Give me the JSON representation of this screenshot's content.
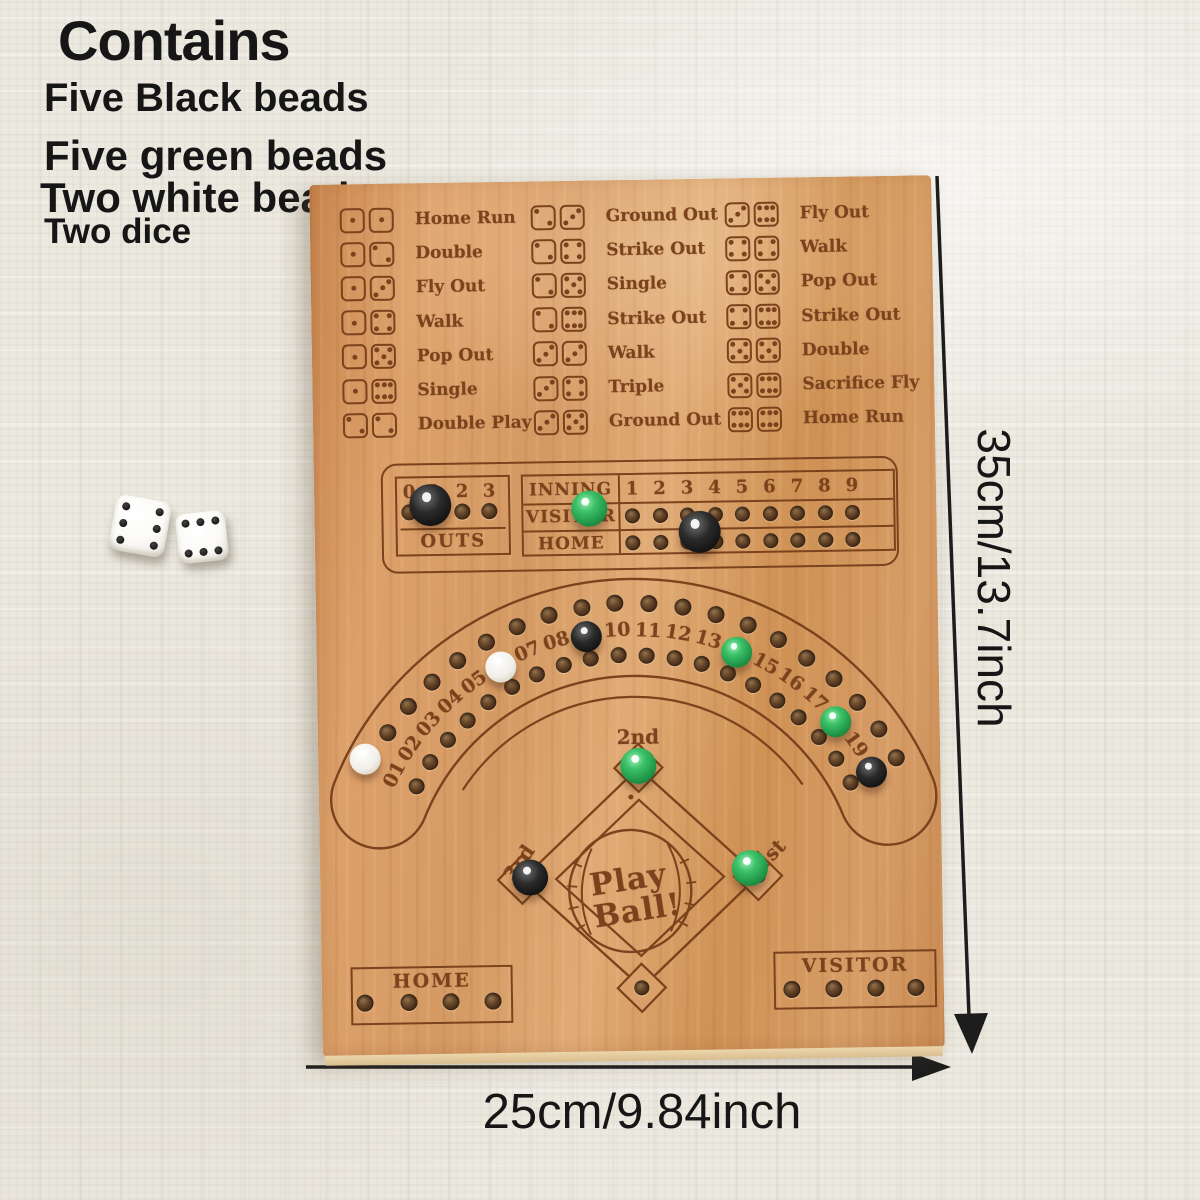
{
  "annotations": {
    "contains_title": "Contains",
    "contains_items": [
      "Five Black beads",
      "Five green beads",
      "Two white beads",
      "Two dice"
    ],
    "height_label": "35cm/13.7inch",
    "width_label": "25cm/9.84inch"
  },
  "photo_dice": [
    {
      "value": 6
    },
    {
      "value": 6
    }
  ],
  "board": {
    "dice_legend": {
      "columns": [
        {
          "rows": [
            {
              "dice": [
                1,
                1
              ],
              "label": "Home Run"
            },
            {
              "dice": [
                1,
                2
              ],
              "label": "Double"
            },
            {
              "dice": [
                1,
                3
              ],
              "label": "Fly Out"
            },
            {
              "dice": [
                1,
                4
              ],
              "label": "Walk"
            },
            {
              "dice": [
                1,
                5
              ],
              "label": "Pop Out"
            },
            {
              "dice": [
                1,
                6
              ],
              "label": "Single"
            },
            {
              "dice": [
                2,
                2
              ],
              "label": "Double Play"
            }
          ]
        },
        {
          "rows": [
            {
              "dice": [
                2,
                3
              ],
              "label": "Ground Out"
            },
            {
              "dice": [
                2,
                4
              ],
              "label": "Strike Out"
            },
            {
              "dice": [
                2,
                5
              ],
              "label": "Single"
            },
            {
              "dice": [
                2,
                6
              ],
              "label": "Strike Out"
            },
            {
              "dice": [
                3,
                3
              ],
              "label": "Walk"
            },
            {
              "dice": [
                3,
                4
              ],
              "label": "Triple"
            },
            {
              "dice": [
                3,
                5
              ],
              "label": "Ground Out"
            }
          ]
        },
        {
          "rows": [
            {
              "dice": [
                3,
                6
              ],
              "label": "Fly Out"
            },
            {
              "dice": [
                4,
                4
              ],
              "label": "Walk"
            },
            {
              "dice": [
                4,
                5
              ],
              "label": "Pop Out"
            },
            {
              "dice": [
                4,
                6
              ],
              "label": "Strike Out"
            },
            {
              "dice": [
                5,
                5
              ],
              "label": "Double"
            },
            {
              "dice": [
                5,
                6
              ],
              "label": "Sacrifice Fly"
            },
            {
              "dice": [
                6,
                6
              ],
              "label": "Home Run"
            }
          ]
        }
      ]
    },
    "scoreboard": {
      "outs": {
        "numbers": [
          "0",
          "1",
          "2",
          "3"
        ],
        "label": "OUTS",
        "bead": {
          "color": "black",
          "index": 1
        }
      },
      "innings": {
        "header": "INNING",
        "numbers": [
          "1",
          "2",
          "3",
          "4",
          "5",
          "6",
          "7",
          "8",
          "9"
        ],
        "rows": [
          {
            "label": "VISITOR",
            "bead": {
              "color": "green",
              "inning": 2
            }
          },
          {
            "label": "HOME",
            "bead": {
              "color": "black",
              "inning": 6
            }
          }
        ]
      }
    },
    "track": {
      "positions": [
        "01",
        "02",
        "03",
        "04",
        "05",
        "06",
        "07",
        "08",
        "09",
        "10",
        "11",
        "12",
        "13",
        "14",
        "15",
        "16",
        "17",
        "18",
        "19",
        "20"
      ],
      "beads": [
        {
          "position": "01",
          "color": "white"
        },
        {
          "position": "06",
          "color": "white"
        },
        {
          "position": "09",
          "color": "black"
        },
        {
          "position": "14",
          "color": "green"
        },
        {
          "position": "18",
          "color": "green"
        },
        {
          "position": "20",
          "color": "black"
        }
      ]
    },
    "diamond": {
      "center_text": [
        "Play",
        "Ball!"
      ],
      "bases": [
        {
          "id": "second",
          "label": "2nd",
          "bead": "green"
        },
        {
          "id": "first",
          "label": "1st",
          "bead": "green"
        },
        {
          "id": "third",
          "label": "3rd",
          "bead": "black"
        },
        {
          "id": "home",
          "label": "",
          "bead": null
        }
      ]
    },
    "home_box": {
      "label": "HOME",
      "holes": 4
    },
    "visitor_box": {
      "label": "VISITOR",
      "holes": 4
    }
  },
  "colors": {
    "wood": "#d09a64",
    "engraving": "#7b431d",
    "bead_green": "#2fae55",
    "bead_black": "#161616",
    "bead_white": "#f4f1ea",
    "background": "#ece9e0",
    "annotation": "#161616"
  }
}
